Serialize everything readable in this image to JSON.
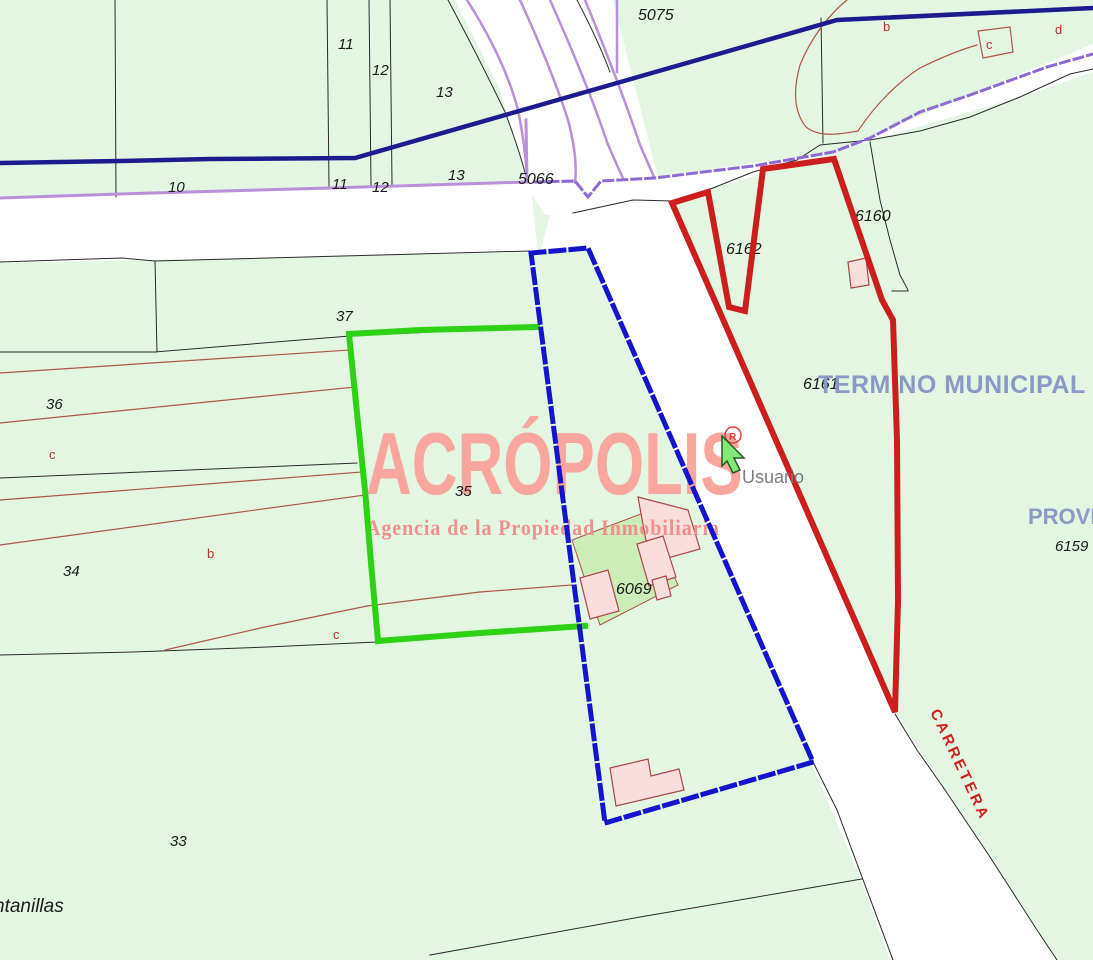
{
  "map": {
    "background": "#e3f6e2",
    "road_color": "#ffffff",
    "colors": {
      "navy_road_line": "#1c1c8f",
      "purple_road_line": "#b98fd9",
      "purple_dash_line": "#8f6ad2",
      "parcel_line": "#2a2a2a",
      "subdivision_line": "#b05545",
      "highlight_green": "#2ed214",
      "highlight_blue": "#1414cc",
      "highlight_red": "#cc1e1e",
      "building_fill": "#f9dedd",
      "courtyard_fill": "#ccecb8",
      "municipal_text": "#8a99c7",
      "watermark_title": "#f9a79e",
      "watermark_subtitle": "#f0908e",
      "carretera_text": "#d02020",
      "usuario_text": "#7b7b7b"
    },
    "watermark": {
      "title": "ACRÓPOLIS",
      "subtitle": "Agencia de la Propiedad Inmobiliaria"
    },
    "base_layers": [
      {
        "t": "poly",
        "n": "road-horizontal-west",
        "p": "0,199 530,181 538,252 0,263",
        "f": "#ffffff"
      },
      {
        "t": "poly",
        "n": "road-fan-north",
        "p": "455,0 613,0 658,178 590,198 527,181 500,90 470,30",
        "f": "#ffffff"
      },
      {
        "t": "poly",
        "n": "road-northeast",
        "p": "524,182 640,179 833,152 1093,44 1093,72 1020,97 870,141 708,190 672,202 573,213 545,215",
        "f": "#ffffff"
      },
      {
        "t": "poly",
        "n": "road-carretera",
        "p": "550,215 672,202 895,712 1057,960 890,960 860,877 810,760 585,245 540,252",
        "f": "#ffffff"
      },
      {
        "t": "path",
        "n": "parcel-line",
        "d": "M115,0 L116,197",
        "s": "#2a2a2a",
        "w": 1
      },
      {
        "t": "path",
        "n": "parcel-line",
        "d": "M327,0 L329,186",
        "s": "#2a2a2a",
        "w": 1
      },
      {
        "t": "path",
        "n": "parcel-line",
        "d": "M369,0 L371,185",
        "s": "#2a2a2a",
        "w": 1
      },
      {
        "t": "path",
        "n": "parcel-line",
        "d": "M390,0 L392,184",
        "s": "#2a2a2a",
        "w": 1
      },
      {
        "t": "path",
        "n": "parcel-line-curve",
        "d": "M448,0 Q480,60 505,112 Q520,152 527,180",
        "s": "#2a2a2a",
        "w": 1
      },
      {
        "t": "path",
        "n": "parcel-line-curve",
        "d": "M577,0 Q598,40 610,72",
        "s": "#2a2a2a",
        "w": 1
      },
      {
        "t": "path",
        "n": "road-south-edge",
        "d": "M0,262 L122,258 L155,261 L380,255 L530,251",
        "s": "#2a2a2a",
        "w": 1
      },
      {
        "t": "path",
        "n": "parcel-line",
        "d": "M155,261 L157,352",
        "s": "#2a2a2a",
        "w": 1
      },
      {
        "t": "path",
        "n": "parcel-line",
        "d": "M0,352 L157,352",
        "s": "#2a2a2a",
        "w": 1
      },
      {
        "t": "path",
        "n": "parcel-37-south",
        "d": "M155,352 L300,340 L350,336 L537,327",
        "s": "#2a2a2a",
        "w": 1
      },
      {
        "t": "path",
        "n": "road-edge",
        "d": "M573,213 L633,200 L672,201",
        "s": "#2a2a2a",
        "w": 1
      },
      {
        "t": "path",
        "n": "road-ne-south-edge",
        "d": "M672,201 L708,190 L753,172 L797,160 L820,145 L870,140 L920,131 L970,117 L1020,97 L1070,74 L1093,69",
        "s": "#2a2a2a",
        "w": 1
      },
      {
        "t": "path",
        "n": "parcel-line",
        "d": "M821,18 L823,143",
        "s": "#2a2a2a",
        "w": 1
      },
      {
        "t": "path",
        "n": "parcel-6160-east",
        "d": "M870,142 L880,200 L890,240 L900,275 L908,290",
        "s": "#2a2a2a",
        "w": 1
      },
      {
        "t": "path",
        "n": "parcel-line",
        "d": "M892,291 L908,291",
        "s": "#2a2a2a",
        "w": 1
      },
      {
        "t": "path",
        "n": "road-west-edge-low",
        "d": "M813,762 L837,810 L862,877 L893,960",
        "s": "#2a2a2a",
        "w": 1
      },
      {
        "t": "path",
        "n": "road-east-edge-low",
        "d": "M895,714 L917,750 L943,787 L990,857 L1037,930 L1057,960",
        "s": "#2a2a2a",
        "w": 1
      },
      {
        "t": "path",
        "n": "parcel-line",
        "d": "M430,955 L640,917 L862,879",
        "s": "#2a2a2a",
        "w": 1
      },
      {
        "t": "path",
        "n": "parcel-line-long",
        "d": "M0,655 L133,652 L267,647 L377,642 L470,635 L585,627",
        "s": "#2a2a2a",
        "w": 1
      },
      {
        "t": "path",
        "n": "parcel-line",
        "d": "M0,478 L357,463",
        "s": "#2a2a2a",
        "w": 1
      },
      {
        "t": "path",
        "n": "subdivision-line",
        "d": "M0,373 L350,350",
        "s": "#b05545",
        "w": 1.2
      },
      {
        "t": "path",
        "n": "subdivision-line",
        "d": "M0,423 L355,387",
        "s": "#b05545",
        "w": 1.2
      },
      {
        "t": "path",
        "n": "subdivision-line",
        "d": "M0,500 L362,472",
        "s": "#b05545",
        "w": 1.2
      },
      {
        "t": "path",
        "n": "subdivision-line",
        "d": "M0,545 L365,495",
        "s": "#b05545",
        "w": 1.2
      },
      {
        "t": "path",
        "n": "subdivision-line",
        "d": "M165,650 L265,627 L367,606 L480,592 L572,585",
        "s": "#b05545",
        "w": 1.2
      },
      {
        "t": "path",
        "n": "subdivision-curve",
        "d": "M847,0 C828,15 810,40 800,65 C793,90 794,112 806,127 C820,138 840,134 858,131",
        "s": "#b05545",
        "w": 1.2
      },
      {
        "t": "path",
        "n": "subdivision-curve",
        "d": "M858,131 C875,105 898,82 920,68 C940,58 960,50 977,45",
        "s": "#b05545",
        "w": 1.2
      },
      {
        "t": "poly",
        "n": "subdivision-c-quad",
        "p": "978,31 1010,27 1013,52 983,58",
        "f": "none",
        "s": "#b05545",
        "w": 1.2
      },
      {
        "t": "path",
        "n": "purple-road-line",
        "d": "M0,198 L120,194 L330,188 L527,182",
        "s": "#b98fd9",
        "w": 3
      },
      {
        "t": "path",
        "n": "purple-road-line",
        "d": "M527,182 L526,120",
        "s": "#b98fd9",
        "w": 3
      },
      {
        "t": "path",
        "n": "purple-road-curve",
        "d": "M467,0 Q505,60 518,110 Q526,150 527,180",
        "s": "#b98fd9",
        "w": 2.5
      },
      {
        "t": "path",
        "n": "purple-road-curve",
        "d": "M520,0 Q552,70 568,120 Q578,158 575,182",
        "s": "#b98fd9",
        "w": 2.5
      },
      {
        "t": "path",
        "n": "purple-road-curve",
        "d": "M550,0 Q588,85 607,142 Q618,168 623,178",
        "s": "#b98fd9",
        "w": 2.5
      },
      {
        "t": "path",
        "n": "purple-road-curve",
        "d": "M585,0 Q620,85 640,145 Q650,168 654,177",
        "s": "#b98fd9",
        "w": 2.5
      },
      {
        "t": "path",
        "n": "purple-road-line",
        "d": "M617,0 L617,72",
        "s": "#b98fd9",
        "w": 2.5
      },
      {
        "t": "path",
        "n": "purple-dash-road",
        "d": "M535,182 L575,181 L588,197 L601,181 L655,178 L703,172 L753,166 L833,152 L870,138 L920,112 L970,95 L1047,67 L1093,54",
        "s": "#8f6ad2",
        "w": 3,
        "da": "9 5"
      },
      {
        "t": "path",
        "n": "navy-boundary-line",
        "d": "M0,163 L120,161 L210,159 L355,158 L837,20 L1093,8",
        "s": "#1c1c8f",
        "w": 4.5
      },
      {
        "t": "poly",
        "n": "courtyard",
        "p": "572,540 646,512 678,585 600,625",
        "f": "#ccecb8",
        "s": "#b05545",
        "w": 1
      },
      {
        "t": "poly",
        "n": "building",
        "p": "638,497 688,510 700,549 650,563",
        "f": "#f9dedd",
        "s": "#a84848",
        "w": 1.2
      },
      {
        "t": "poly",
        "n": "building",
        "p": "637,544 663,536 676,577 649,586",
        "f": "#f9dedd",
        "s": "#a84848",
        "w": 1.2
      },
      {
        "t": "poly",
        "n": "building",
        "p": "580,578 608,570 619,611 590,619",
        "f": "#f9dedd",
        "s": "#a84848",
        "w": 1.2
      },
      {
        "t": "poly",
        "n": "building",
        "p": "652,580 666,576 671,596 657,600",
        "f": "#f9dedd",
        "s": "#a84848",
        "w": 1.2
      },
      {
        "t": "poly",
        "n": "building",
        "p": "610,768 648,759 651,776 679,769 684,790 616,806",
        "f": "#f9dedd",
        "s": "#a84848",
        "w": 1.2
      },
      {
        "t": "poly",
        "n": "building",
        "p": "848,262 866,258 869,285 851,288",
        "f": "#f9dedd",
        "s": "#a84848",
        "w": 1.2
      }
    ],
    "overlay_layers": [
      {
        "t": "text",
        "n": "label-parcel",
        "text": "11",
        "x": 338,
        "y": 49,
        "size": 15,
        "i": true
      },
      {
        "t": "text",
        "n": "label-parcel",
        "text": "12",
        "x": 372,
        "y": 75,
        "size": 15,
        "i": true
      },
      {
        "t": "text",
        "n": "label-parcel",
        "text": "13",
        "x": 436,
        "y": 97,
        "size": 15,
        "i": true
      },
      {
        "t": "text",
        "n": "label-parcel",
        "text": "5075",
        "x": 638,
        "y": 20,
        "size": 16,
        "i": true
      },
      {
        "t": "text",
        "n": "label-parcel",
        "text": "10",
        "x": 168,
        "y": 192,
        "size": 15,
        "i": true
      },
      {
        "t": "text",
        "n": "label-parcel",
        "text": "11",
        "x": 332,
        "y": 189,
        "size": 15,
        "i": true
      },
      {
        "t": "text",
        "n": "label-parcel",
        "text": "12",
        "x": 372,
        "y": 192,
        "size": 15,
        "i": true
      },
      {
        "t": "text",
        "n": "label-parcel",
        "text": "13",
        "x": 448,
        "y": 180,
        "size": 15,
        "i": true
      },
      {
        "t": "text",
        "n": "label-parcel",
        "text": "5066",
        "x": 518,
        "y": 184,
        "size": 16,
        "i": true
      },
      {
        "t": "text",
        "n": "label-parcel",
        "text": "37",
        "x": 336,
        "y": 321,
        "size": 15,
        "i": true
      },
      {
        "t": "text",
        "n": "label-parcel",
        "text": "36",
        "x": 46,
        "y": 409,
        "size": 15,
        "i": true
      },
      {
        "t": "text",
        "n": "label-subparcel",
        "text": "c",
        "x": 49,
        "y": 459,
        "size": 13,
        "c": "#c03030"
      },
      {
        "t": "text",
        "n": "label-parcel",
        "text": "34",
        "x": 63,
        "y": 576,
        "size": 15,
        "i": true
      },
      {
        "t": "text",
        "n": "label-subparcel",
        "text": "b",
        "x": 207,
        "y": 558,
        "size": 13,
        "c": "#c03030"
      },
      {
        "t": "text",
        "n": "label-subparcel",
        "text": "c",
        "x": 333,
        "y": 639,
        "size": 13,
        "c": "#c03030"
      },
      {
        "t": "text",
        "n": "label-parcel",
        "text": "35",
        "x": 455,
        "y": 496,
        "size": 15,
        "i": true
      },
      {
        "t": "text",
        "n": "label-parcel",
        "text": "33",
        "x": 170,
        "y": 846,
        "size": 15,
        "i": true
      },
      {
        "t": "text",
        "n": "label-place",
        "text": "ntanillas",
        "x": -6,
        "y": 912,
        "size": 19,
        "i": true
      },
      {
        "t": "text",
        "n": "label-parcel",
        "text": "6162",
        "x": 726,
        "y": 254,
        "size": 16,
        "i": true
      },
      {
        "t": "text",
        "n": "label-parcel",
        "text": "6160",
        "x": 855,
        "y": 221,
        "size": 16,
        "i": true
      },
      {
        "t": "text",
        "n": "label-parcel",
        "text": "6161",
        "x": 803,
        "y": 389,
        "size": 16,
        "i": true
      },
      {
        "t": "text",
        "n": "label-parcel",
        "text": "6159",
        "x": 1055,
        "y": 551,
        "size": 15,
        "i": true
      },
      {
        "t": "text",
        "n": "label-parcel",
        "text": "6069",
        "x": 616,
        "y": 594,
        "size": 16,
        "i": true
      },
      {
        "t": "text",
        "n": "label-subparcel",
        "text": "b",
        "x": 883,
        "y": 31,
        "size": 13,
        "c": "#c03030"
      },
      {
        "t": "text",
        "n": "label-subparcel",
        "text": "c",
        "x": 986,
        "y": 49,
        "size": 13,
        "c": "#c03030"
      },
      {
        "t": "text",
        "n": "label-subparcel",
        "text": "d",
        "x": 1055,
        "y": 34,
        "size": 13,
        "c": "#c03030"
      },
      {
        "t": "text",
        "n": "label-termino-municipal",
        "text": "TERMINO MUNICIPAL",
        "x": 818,
        "y": 393,
        "size": 25,
        "b": true,
        "c": "#8a99c7",
        "ls": "0.5"
      },
      {
        "t": "text",
        "n": "label-provincia",
        "text": "PROVINCIA",
        "x": 1028,
        "y": 524,
        "size": 22,
        "b": true,
        "c": "#8a99c7"
      },
      {
        "t": "text",
        "n": "label-carretera",
        "text": "CARRETERA",
        "x": 930,
        "y": 712,
        "size": 15,
        "b": true,
        "c": "#d02020",
        "ls": "3",
        "r": 65
      },
      {
        "t": "path",
        "n": "highlight-green-top",
        "d": "M349,334 L420,330 L537,327",
        "s": "#2ed214",
        "w": 6
      },
      {
        "t": "path",
        "n": "highlight-green-left",
        "d": "M349,334 L358,423 L365,490 L371,563 L378,641",
        "s": "#2ed214",
        "w": 6
      },
      {
        "t": "path",
        "n": "highlight-green-bottom",
        "d": "M378,641 L480,633 L585,626",
        "s": "#2ed214",
        "w": 6
      },
      {
        "t": "path",
        "n": "highlight-blue-parcel",
        "d": "M531,253 L588,248 L813,762 L605,823 Z",
        "s": "#1414cc",
        "w": 5,
        "da": "13 7"
      },
      {
        "t": "path",
        "n": "highlight-red-parcel",
        "d": "M672,203 L708,192 L729,307 L745,311 L763,169 L834,159 L882,300 L893,320 L897,440 L898,600 L895,712 Z",
        "s": "#cc1e1e",
        "w": 6
      },
      {
        "t": "circle",
        "n": "registered-mark-circle",
        "cx": 733,
        "cy": 435,
        "rr": 8,
        "s": "#e04040",
        "w": 1.5,
        "f": "none"
      },
      {
        "t": "text",
        "n": "registered-mark-r",
        "text": "R",
        "x": 729,
        "y": 440,
        "size": 10,
        "b": true,
        "c": "#e04040"
      },
      {
        "t": "poly",
        "n": "user-cursor",
        "p": "722,436 744,458 734,458 740,470 733,473 727,461 722,466",
        "f": "#86e878",
        "s": "#225c22",
        "w": 1.5
      },
      {
        "t": "text",
        "n": "label-usuario",
        "text": "Usuario",
        "x": 742,
        "y": 483,
        "size": 18,
        "c": "#7b7b7b"
      }
    ]
  }
}
